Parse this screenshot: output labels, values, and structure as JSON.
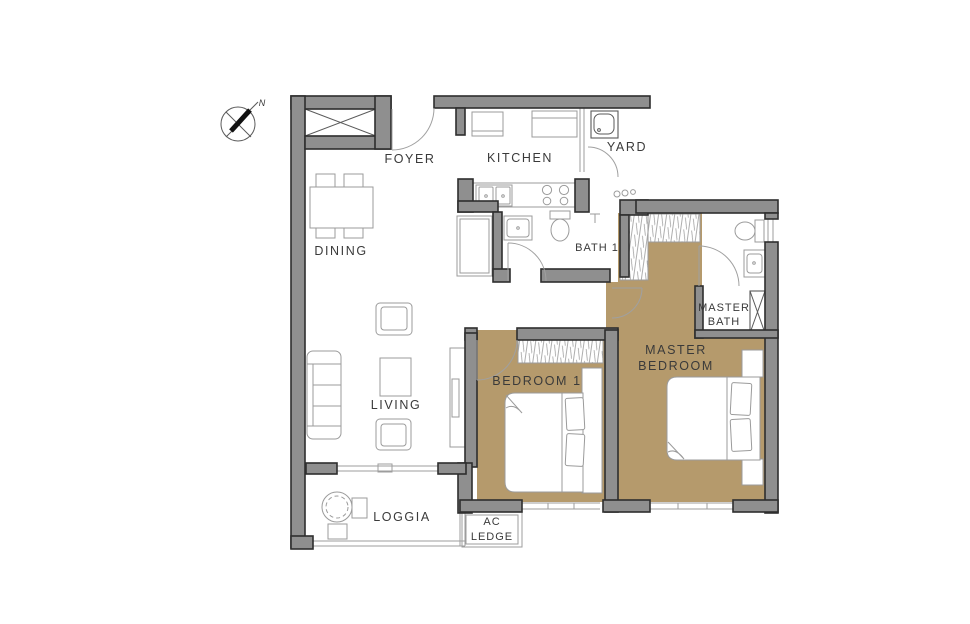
{
  "compass": {
    "north_label": "N"
  },
  "colors": {
    "wall": "#8f8f8f",
    "wall_outline": "#2e2e2e",
    "floor_tan": "#b59a6c",
    "furniture_line": "#9b9b9b",
    "dark_line": "#5a5a5a",
    "text": "#3a3a3a"
  },
  "rooms": {
    "foyer": {
      "label": "FOYER"
    },
    "dining": {
      "label": "DINING"
    },
    "kitchen": {
      "label": "KITCHEN"
    },
    "yard": {
      "label": "YARD"
    },
    "bath1": {
      "label": "BATH 1"
    },
    "master_bath": {
      "line1": "MASTER",
      "line2": "BATH"
    },
    "living": {
      "label": "LIVING"
    },
    "bedroom1": {
      "label": "BEDROOM 1"
    },
    "master_bedroom": {
      "line1": "MASTER",
      "line2": "BEDROOM"
    },
    "loggia": {
      "label": "LOGGIA"
    },
    "ac_ledge": {
      "line1": "AC",
      "line2": "LEDGE"
    }
  }
}
